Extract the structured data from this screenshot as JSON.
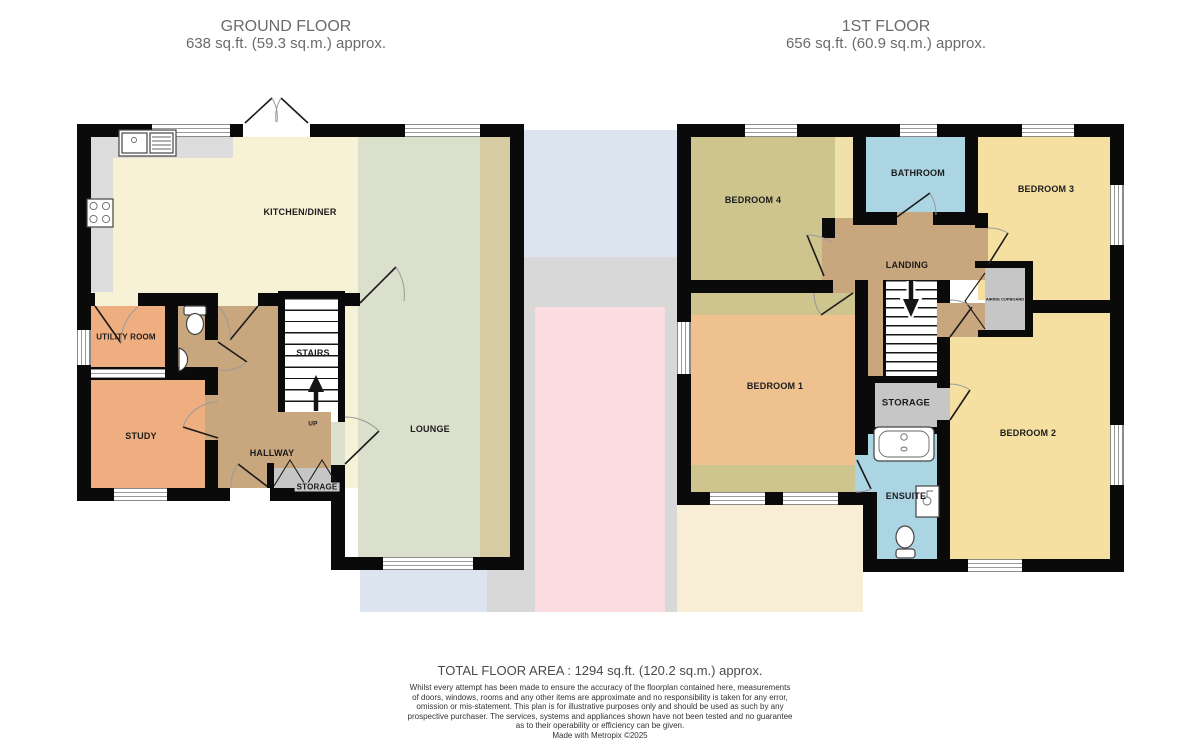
{
  "ground_floor": {
    "title": "GROUND FLOOR",
    "area": "638 sq.ft. (59.3 sq.m.) approx.",
    "labels": {
      "kitchen_diner": "KITCHEN/DINER",
      "utility_room": "UTILITY ROOM",
      "stairs": "STAIRS",
      "up": "UP",
      "study": "STUDY",
      "hallway": "HALLWAY",
      "storage": "STORAGE",
      "lounge": "LOUNGE"
    }
  },
  "first_floor": {
    "title": "1ST FLOOR",
    "area": "656 sq.ft. (60.9 sq.m.) approx.",
    "labels": {
      "bedroom4": "BEDROOM 4",
      "bathroom": "BATHROOM",
      "bedroom3": "BEDROOM 3",
      "landing": "LANDING",
      "airing_cupboard": "AIRING CUPBOARD",
      "bedroom1": "BEDROOM 1",
      "storage": "STORAGE",
      "ensuite": "ENSUITE",
      "bedroom2": "BEDROOM 2"
    }
  },
  "footer": {
    "total_area": "TOTAL FLOOR AREA : 1294 sq.ft. (120.2 sq.m.) approx.",
    "disclaimer_lines": [
      "Whilst every attempt has been made to ensure the accuracy of the floorplan contained here, measurements",
      "of doors, windows, rooms and any other items are approximate and no responsibility is taken for any error,",
      "omission or mis-statement. This plan is for illustrative purposes only and should be used as such by any",
      "prospective purchaser. The services, systems and appliances shown have not been tested and no guarantee",
      "as to their operability or efficiency can be given."
    ],
    "credit": "Made with Metropix ©2025"
  },
  "colors": {
    "wall": "#0a0a0a",
    "cream": "#f7f1d6",
    "counter": "#dcdcdc",
    "sage": "#dbe0cd",
    "khaki": "#d6cca3",
    "orange": "#efae80",
    "tan": "#c9a77e",
    "grayfloor": "#c6c6c6",
    "olive": "#cdc48e",
    "blue": "#abd5e2",
    "yellow": "#f5e0a2",
    "peach": "#eec18f",
    "cream2": "#f0e0ab",
    "washblue": "#dce4f0",
    "washgray": "#d8d8d8",
    "washpink": "#fbdce0",
    "washcream": "#f8eed6",
    "ink": "#1b1b1b",
    "muted": "#6b6b6b",
    "foot": "#4a4a4a",
    "small": "#333333"
  }
}
